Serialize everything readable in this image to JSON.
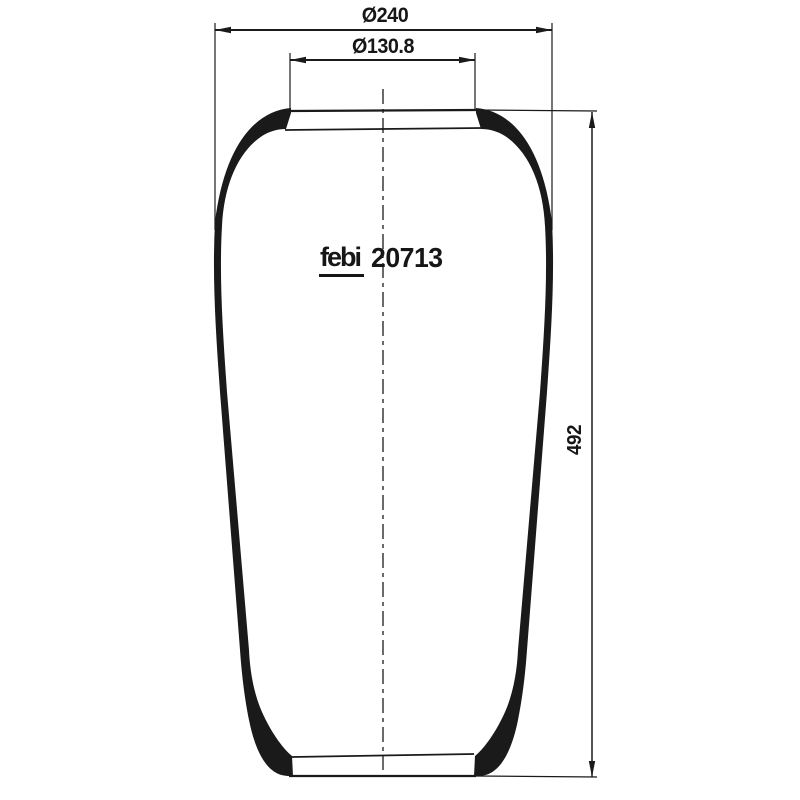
{
  "drawing": {
    "brand_logo": "febi",
    "part_number": "20713",
    "dim_outer_diameter": "Ø240",
    "dim_neck_diameter": "Ø130.8",
    "dim_height": "492",
    "line_color": "#1a1a1a",
    "background_color": "#ffffff"
  }
}
